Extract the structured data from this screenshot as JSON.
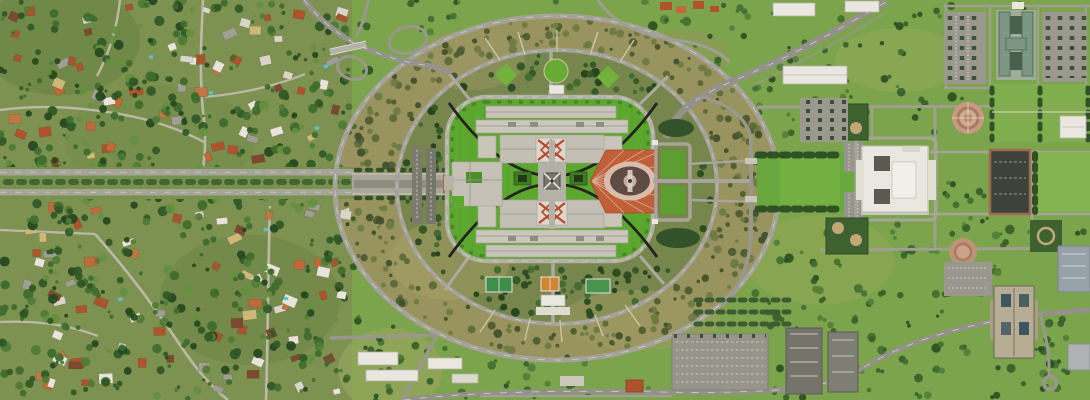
{
  "scene": {
    "type": "aerial-photograph",
    "landmarks": [
      "parliament-house",
      "flag-mast",
      "forecourt-mosaic",
      "capital-circle",
      "state-circle",
      "federation-mall",
      "old-parliament-house",
      "rose-gardens",
      "suburb-forrest",
      "commonwealth-avenue",
      "interchange",
      "parking-lots",
      "office-buildings",
      "tennis-courts"
    ]
  },
  "palette": {
    "suburbBase": "#7d9150",
    "parkBase": "#7ca44c",
    "scrubBase": "#99945f",
    "innerRingBase": "#76864c",
    "lawn": "#5ca72e",
    "roadLight": "#a7a49a",
    "roadMid": "#95938b",
    "bldg": "#c7c3b8",
    "whiteBldg": "#e9e7df",
    "forecourt": "#c05f38",
    "mosaicRing": "#d9bdaa",
    "mosaicDark": "#5d4b44",
    "roofRed": "#b0522c",
    "treeRow": "#2f5123",
    "hedge": "#3e6130",
    "pool": "#5ac2d8",
    "courtGreen": "#3f8f4a",
    "courtOrange": "#d08534"
  },
  "generator": {
    "seed": 20240,
    "suburbHouses": 150,
    "suburbTrees": 560,
    "parkTrees": 310,
    "scrubBushes": 390,
    "innerBushes": 330,
    "pools": 10,
    "roofColors": [
      "#b0522c",
      "#b0522c",
      "#c2693a",
      "#a5562e",
      "#9f9f96",
      "#d9d5c9",
      "#e8e4d9",
      "#e8e4d9",
      "#7c4a30",
      "#cdb877",
      "#c47544"
    ],
    "treeColors": [
      "#24461d",
      "#2f5726",
      "#2f5726",
      "#3d6b2e",
      "#3d6b2e",
      "#4d7c35",
      "#63903e"
    ],
    "parkTreeColors": [
      "#2c4f22",
      "#36602a",
      "#36602a",
      "#426f30",
      "#527e38"
    ],
    "scrubColors": [
      "#41502c",
      "#4e5c33",
      "#5c6a3a",
      "#6e7a45",
      "#6e7a45"
    ],
    "innerBushColors": [
      "#2a4a20",
      "#335628",
      "#24411b",
      "#3f6a30"
    ],
    "clearRects": [
      [
        755,
        146,
        110,
        70
      ],
      [
        850,
        134,
        92,
        90
      ],
      [
        938,
        6,
        154,
        80
      ],
      [
        988,
        82,
        104,
        60
      ],
      [
        1034,
        148,
        58,
        66
      ],
      [
        668,
        330,
        104,
        68
      ],
      [
        986,
        282,
        52,
        78
      ],
      [
        986,
        146,
        48,
        72
      ],
      [
        944,
        100,
        60,
        44
      ]
    ]
  }
}
